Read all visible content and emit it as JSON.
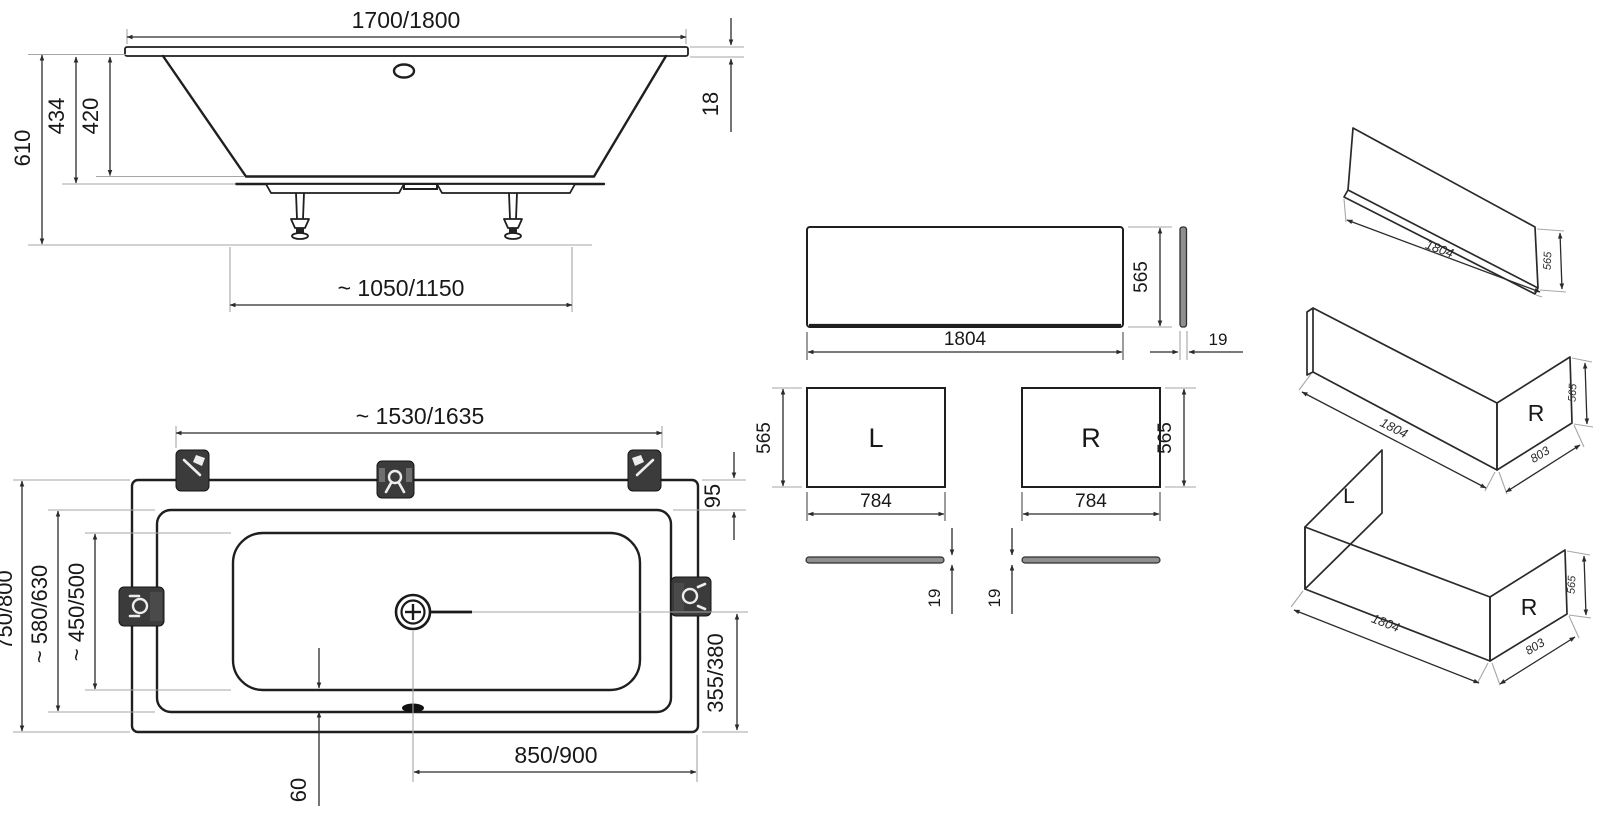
{
  "drawing": {
    "background": "#ffffff",
    "line_color": "#1f1f1f",
    "extension_line_color": "#a6a6a6",
    "panel_fill_gray": "#8f8f8f",
    "bracket_color": "#3b3b3b"
  },
  "side_view": {
    "dim_top_width": "1700/1800",
    "dim_total_height": "610",
    "dim_depth_outer": "434",
    "dim_depth_inner": "420",
    "dim_rim_thickness": "18",
    "dim_support_span": "~ 1050/1150"
  },
  "plan_view": {
    "dim_bracket_span": "~ 1530/1635",
    "dim_rim_offset": "95",
    "dim_width_outer": "750/800",
    "dim_width_rim": "~ 580/630",
    "dim_width_basin": "~ 450/500",
    "dim_drain_to_edge": "355/380",
    "dim_drain_to_end": "850/900",
    "dim_overflow_gap": "60"
  },
  "front_panel": {
    "dim_length": "1804",
    "dim_height": "565",
    "dim_thickness": "19"
  },
  "side_panels": {
    "left_label": "L",
    "right_label": "R",
    "dim_width": "784",
    "dim_height": "565",
    "dim_thickness": "19"
  },
  "iso_views": {
    "front": {
      "dim_length": "1804",
      "dim_height": "565"
    },
    "front_right": {
      "label_side": "R",
      "dim_length": "1804",
      "dim_side": "803",
      "dim_height": "565"
    },
    "u_shape": {
      "label_left": "L",
      "label_right": "R",
      "dim_length": "1804",
      "dim_side": "803",
      "dim_height": "565"
    }
  }
}
